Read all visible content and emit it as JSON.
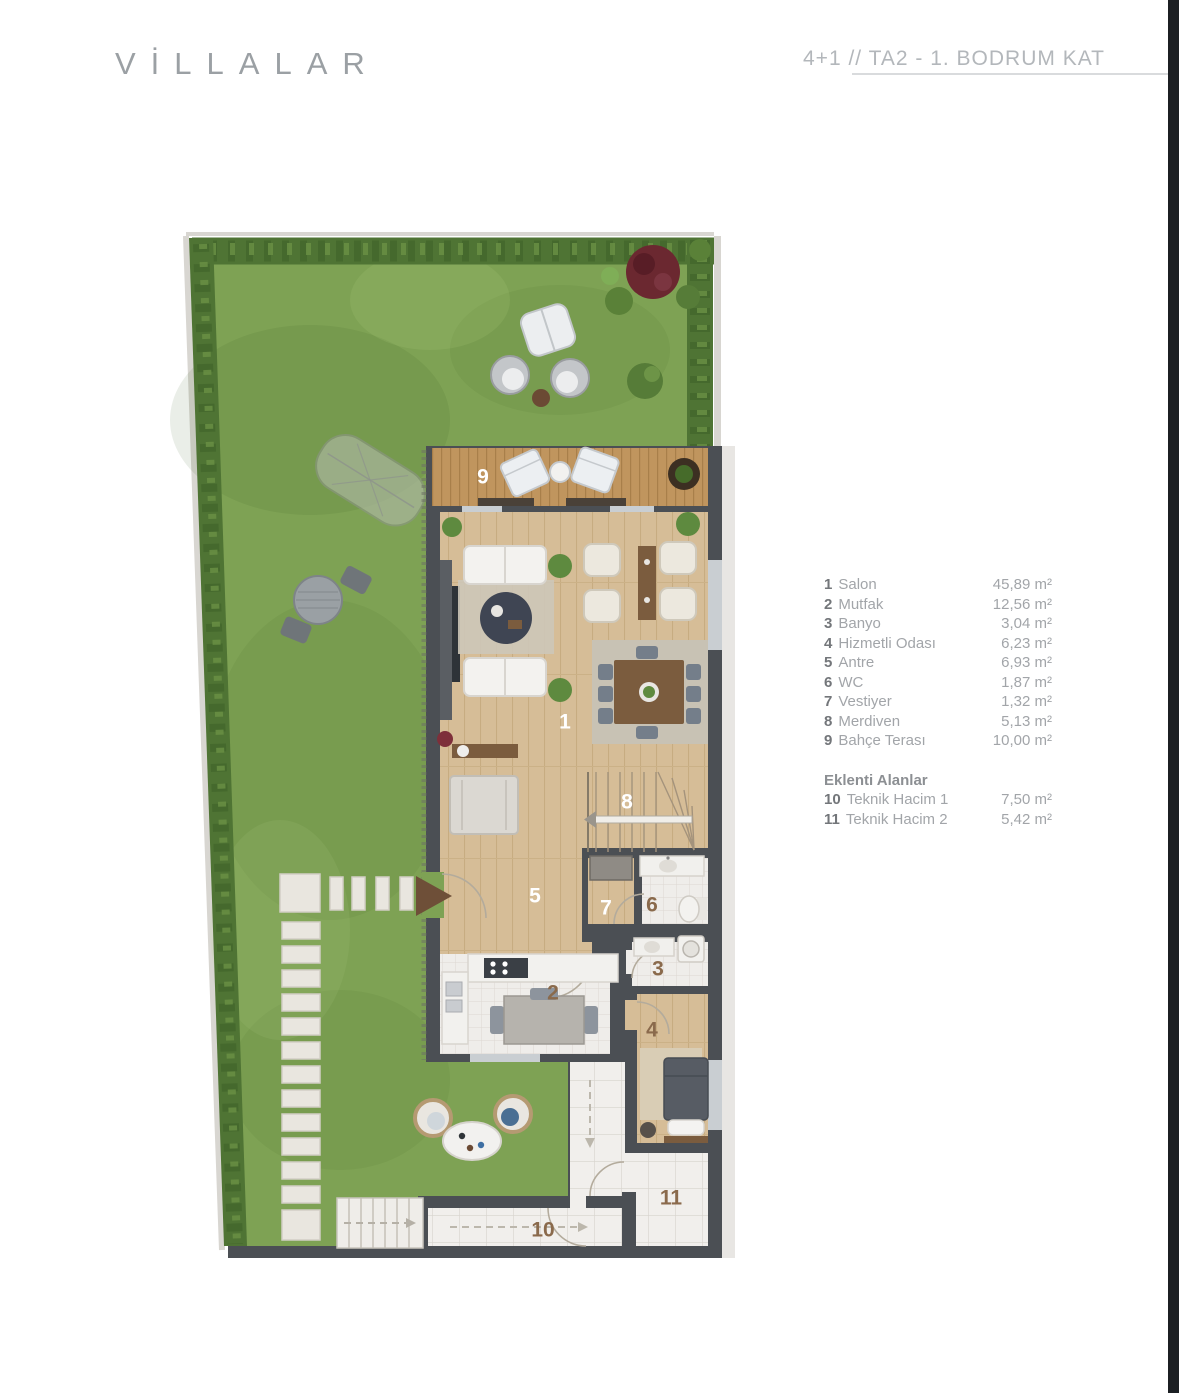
{
  "page": {
    "title": "VİLLALAR"
  },
  "header": {
    "plan_code": "4+1 // TA2 - 1. BODRUM KAT"
  },
  "legend": {
    "items": [
      {
        "num": "1",
        "name": "Salon",
        "area": "45,89 m²"
      },
      {
        "num": "2",
        "name": "Mutfak",
        "area": "12,56 m²"
      },
      {
        "num": "3",
        "name": "Banyo",
        "area": "3,04 m²"
      },
      {
        "num": "4",
        "name": "Hizmetli Odası",
        "area": "6,23 m²"
      },
      {
        "num": "5",
        "name": "Antre",
        "area": "6,93 m²"
      },
      {
        "num": "6",
        "name": "WC",
        "area": "1,87 m²"
      },
      {
        "num": "7",
        "name": "Vestiyer",
        "area": "1,32 m²"
      },
      {
        "num": "8",
        "name": "Merdiven",
        "area": "5,13 m²"
      },
      {
        "num": "9",
        "name": "Bahçe Terası",
        "area": "10,00 m²"
      }
    ],
    "section_title": "Eklenti Alanlar",
    "extra_items": [
      {
        "num": "10",
        "name": "Teknik Hacim 1",
        "area": "7,50 m²"
      },
      {
        "num": "11",
        "name": "Teknik Hacim 2",
        "area": "5,42 m²"
      }
    ]
  },
  "plan": {
    "labels": [
      {
        "num": "9"
      },
      {
        "num": "1"
      },
      {
        "num": "8"
      },
      {
        "num": "5"
      },
      {
        "num": "7"
      },
      {
        "num": "6"
      },
      {
        "num": "3"
      },
      {
        "num": "2"
      },
      {
        "num": "4"
      },
      {
        "num": "10"
      },
      {
        "num": "11"
      }
    ]
  },
  "colors": {
    "grass": "#7EA254",
    "hedge": "#4F7434",
    "wall": "#4B4F54",
    "wood_floor": "#D6BD97",
    "deck": "#C0955E",
    "tile": "#EFEDEA",
    "label_brown": "#8A6A4C",
    "label_white": "#FFFFFF",
    "title_gray": "#9BA0A4",
    "edge_bar": "#1C1F23"
  }
}
